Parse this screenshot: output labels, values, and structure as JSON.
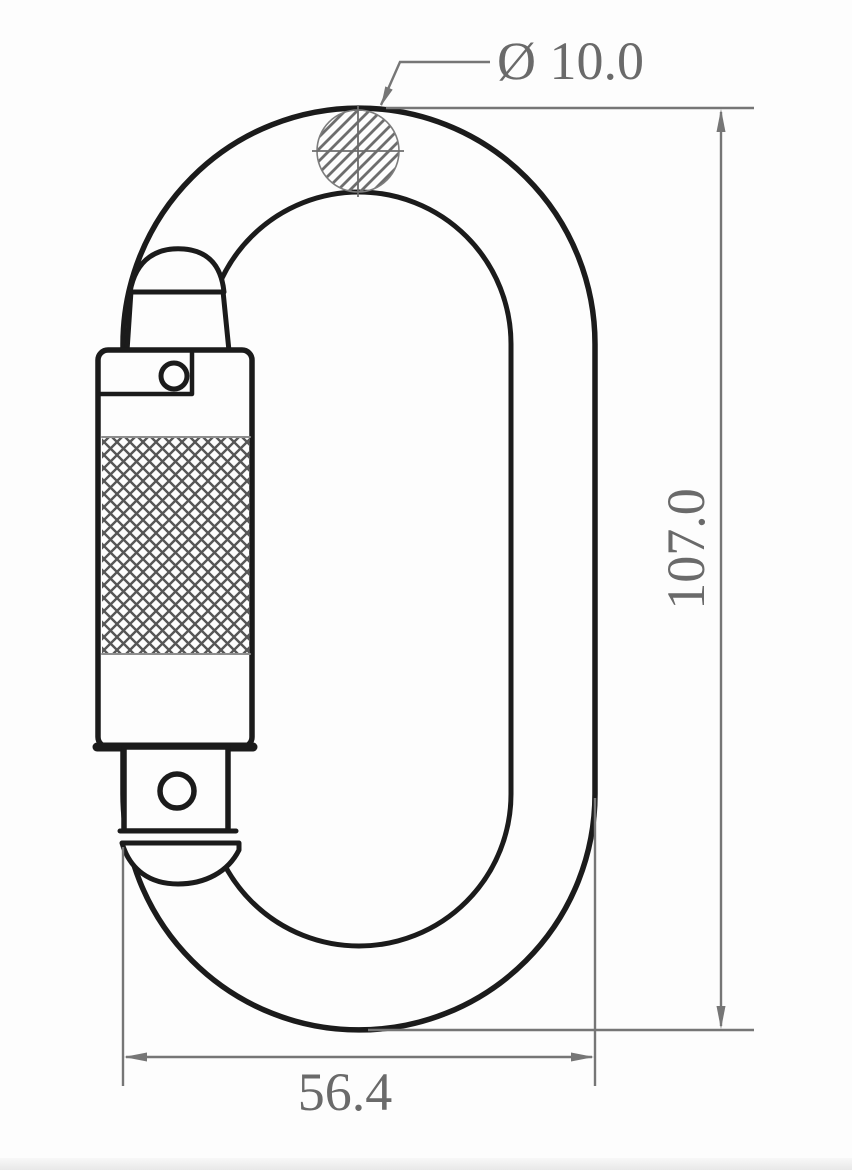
{
  "drawing": {
    "type": "technical-dimension-drawing",
    "subject": "oval twist-lock carabiner, front view",
    "labels": {
      "diameter": "Ø 10.0",
      "height": "107.0",
      "width": "56.4"
    },
    "colors": {
      "outline": "#1b1b1b",
      "dimension_line": "#767676",
      "dimension_text": "#6a6a6a",
      "knurl": "#565656",
      "hatch": "#6d6d6d",
      "background": "#fdfdfd"
    }
  }
}
